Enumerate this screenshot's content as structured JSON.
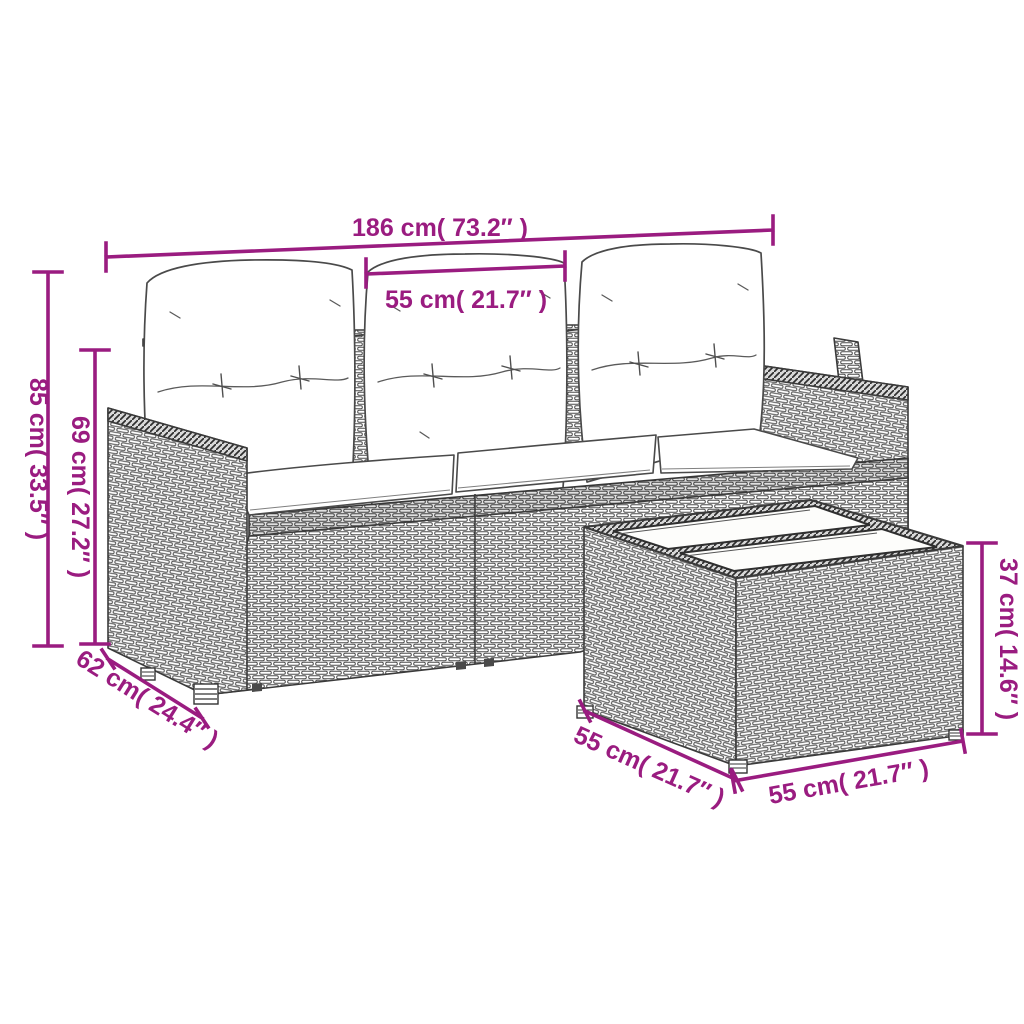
{
  "alt": "Line-art dimension diagram of a poly rattan garden set: three-seat sofa with back and seat cushions, and a square rattan table with a two-panel glass slat top",
  "dimensions": {
    "sofa_width": "186 cm( 73.2″ )",
    "middle_seat_width": "55 cm( 21.7″ )",
    "sofa_height": "85 cm( 33.5″ )",
    "backrest_height": "69 cm( 27.2″ )",
    "sofa_depth": "62 cm( 24.4″ )",
    "table_depth": "55 cm( 21.7″ )",
    "table_width": "55 cm( 21.7″ )",
    "table_height": "37 cm( 14.6″ )"
  },
  "colors": {
    "dimension_annotation": "#9A1C80",
    "line_art": "#3B3B3B",
    "background": "#FFFFFF",
    "cushion_fill": "#FFFFFF"
  }
}
